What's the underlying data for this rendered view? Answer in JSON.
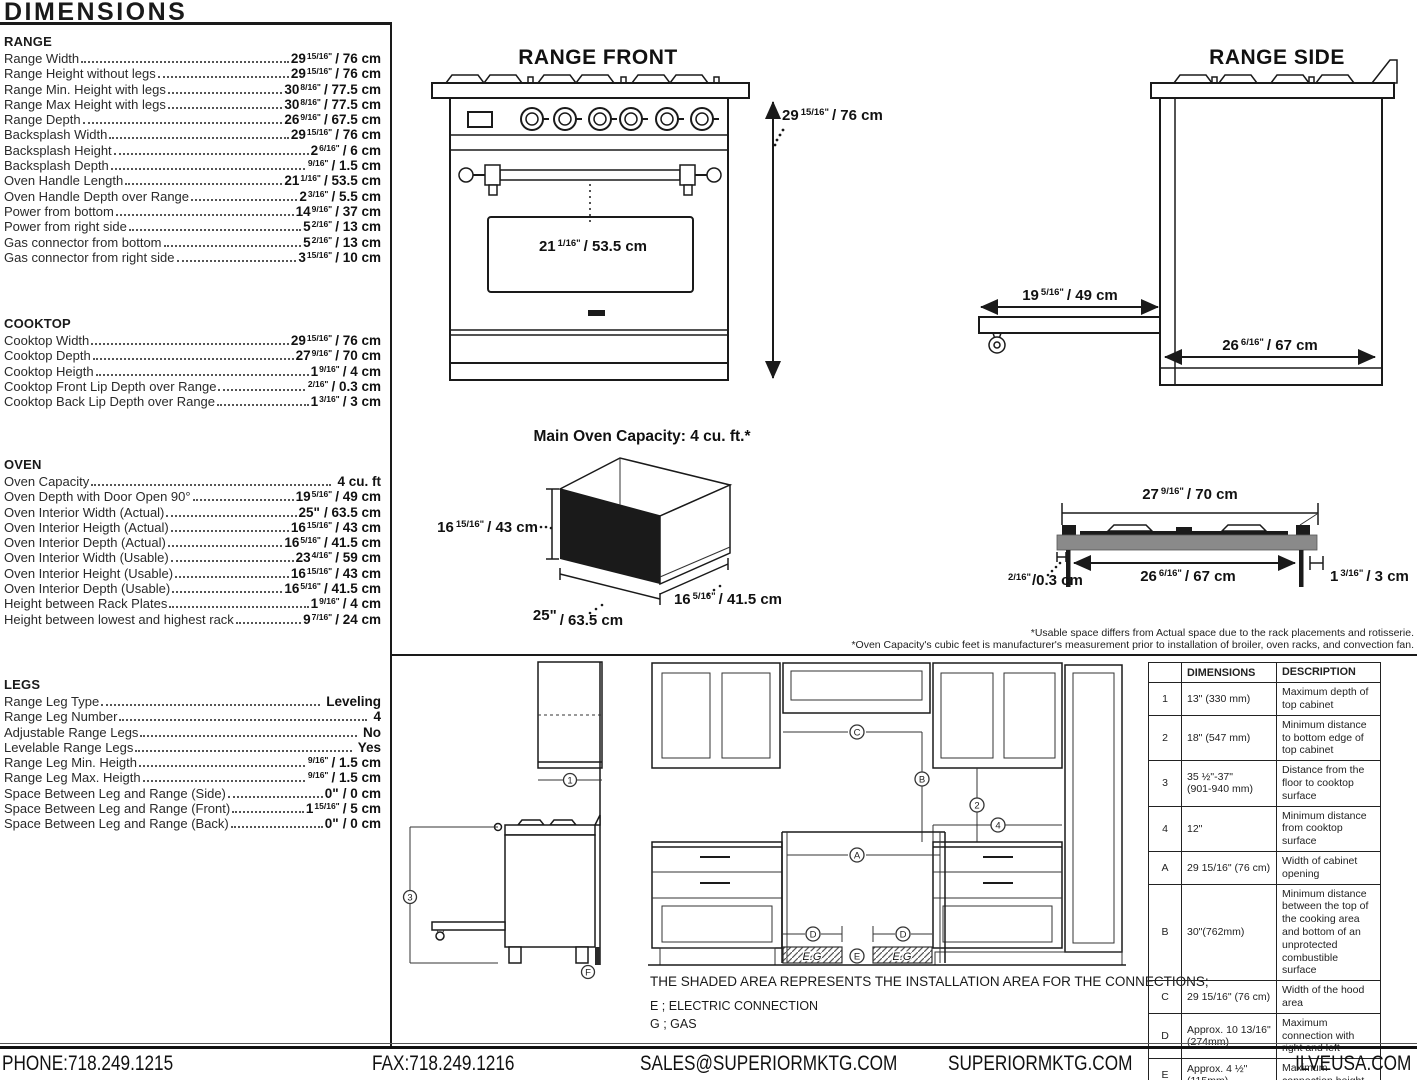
{
  "title": "DIMENSIONS",
  "specs": {
    "range": {
      "heading": "RANGE",
      "items": [
        {
          "label": "Range Width",
          "imp": "29",
          "frac": "15/16\"",
          "met": "/ 76 cm"
        },
        {
          "label": "Range Height without legs",
          "imp": "29",
          "frac": "15/16\"",
          "met": "/ 76 cm"
        },
        {
          "label": "Range Min. Height with legs",
          "imp": "30",
          "frac": "8/16\"",
          "met": "/ 77.5 cm"
        },
        {
          "label": "Range Max Height with legs",
          "imp": "30",
          "frac": "8/16\"",
          "met": "/ 77.5 cm"
        },
        {
          "label": "Range Depth",
          "imp": "26",
          "frac": "9/16\"",
          "met": "/ 67.5 cm"
        },
        {
          "label": "Backsplash Width",
          "imp": "29",
          "frac": "15/16\"",
          "met": "/ 76 cm"
        },
        {
          "label": "Backsplash Height",
          "imp": "2",
          "frac": "6/16\"",
          "met": "/ 6 cm"
        },
        {
          "label": "Backsplash Depth",
          "imp": "",
          "frac": "9/16\"",
          "met": "/ 1.5 cm"
        },
        {
          "label": "Oven Handle Length",
          "imp": "21",
          "frac": "1/16\"",
          "met": "/ 53.5 cm"
        },
        {
          "label": "Oven Handle Depth over Range",
          "imp": "2",
          "frac": "3/16\"",
          "met": "/ 5.5 cm"
        },
        {
          "label": "Power from bottom",
          "imp": "14",
          "frac": "9/16\"",
          "met": "/ 37 cm"
        },
        {
          "label": "Power from right side",
          "imp": "5",
          "frac": "2/16\"",
          "met": "/ 13 cm"
        },
        {
          "label": "Gas connector from bottom",
          "imp": "5",
          "frac": "2/16\"",
          "met": "/ 13 cm"
        },
        {
          "label": "Gas connector from right side",
          "imp": "3",
          "frac": "15/16\"",
          "met": "/ 10 cm"
        }
      ]
    },
    "cooktop": {
      "heading": "COOKTOP",
      "items": [
        {
          "label": "Cooktop Width",
          "imp": "29",
          "frac": "15/16\"",
          "met": "/ 76 cm"
        },
        {
          "label": "Cooktop Depth",
          "imp": "27",
          "frac": "9/16\"",
          "met": "/ 70 cm"
        },
        {
          "label": "Cooktop Heigth",
          "imp": "1",
          "frac": "9/16\"",
          "met": "/ 4 cm"
        },
        {
          "label": "Cooktop Front Lip Depth over Range",
          "imp": "",
          "frac": "2/16\"",
          "met": "/ 0.3 cm"
        },
        {
          "label": "Cooktop Back Lip Depth over Range",
          "imp": "1",
          "frac": "3/16\"",
          "met": "/ 3 cm"
        }
      ]
    },
    "oven": {
      "heading": "OVEN",
      "items": [
        {
          "label": "Oven Capacity",
          "imp": "",
          "frac": "",
          "met": "4 cu. ft"
        },
        {
          "label": "Oven Depth with Door Open 90°",
          "imp": "19",
          "frac": "5/16\"",
          "met": "/ 49 cm"
        },
        {
          "label": "Oven Interior Width (Actual)",
          "imp": "25\"",
          "frac": "",
          "met": "/ 63.5 cm"
        },
        {
          "label": "Oven Interior Heigth (Actual)",
          "imp": "16",
          "frac": "15/16\"",
          "met": "/ 43 cm"
        },
        {
          "label": "Oven Interior Depth (Actual)",
          "imp": "16",
          "frac": "5/16\"",
          "met": "/ 41.5 cm"
        },
        {
          "label": "Oven Interior Width (Usable)",
          "imp": "23",
          "frac": "4/16\"",
          "met": "/ 59 cm"
        },
        {
          "label": "Oven Interior Height (Usable)",
          "imp": "16",
          "frac": "15/16\"",
          "met": "/ 43 cm"
        },
        {
          "label": "Oven Interior Depth (Usable)",
          "imp": "16",
          "frac": "5/16\"",
          "met": "/ 41.5 cm"
        },
        {
          "label": "Height between Rack Plates",
          "imp": "1",
          "frac": "9/16\"",
          "met": "/ 4 cm"
        },
        {
          "label": "Height between lowest and highest rack",
          "imp": "9",
          "frac": "7/16\"",
          "met": "/ 24 cm"
        }
      ]
    },
    "legs": {
      "heading": "LEGS",
      "items": [
        {
          "label": "Range Leg Type",
          "imp": "",
          "frac": "",
          "met": "Leveling"
        },
        {
          "label": "Range Leg Number",
          "imp": "",
          "frac": "",
          "met": "4"
        },
        {
          "label": "Adjustable Range Legs",
          "imp": "",
          "frac": "",
          "met": "No"
        },
        {
          "label": "Levelable Range Legs",
          "imp": "",
          "frac": "",
          "met": "Yes"
        },
        {
          "label": "Range Leg Min. Heigth",
          "imp": "",
          "frac": "9/16\"",
          "met": "/ 1.5 cm"
        },
        {
          "label": "Range Leg Max. Heigth",
          "imp": "",
          "frac": "9/16\"",
          "met": "/ 1.5 cm"
        },
        {
          "label": "Space Between Leg and Range (Side)",
          "imp": "0\"",
          "frac": "",
          "met": "/ 0 cm"
        },
        {
          "label": "Space Between Leg and Range (Front)",
          "imp": "1",
          "frac": "15/16\"",
          "met": "/ 5 cm"
        },
        {
          "label": "Space Between Leg and Range (Back)",
          "imp": "0\"",
          "frac": "",
          "met": "/ 0 cm"
        }
      ]
    }
  },
  "diagrams": {
    "range_front": {
      "title": "RANGE FRONT",
      "height": {
        "imp": "29",
        "frac": "15/16\"",
        "met": "/ 76 cm"
      },
      "handle": {
        "imp": "21",
        "frac": "1/16\"",
        "met": "/ 53.5 cm"
      }
    },
    "range_side": {
      "title": "RANGE SIDE",
      "door_open": {
        "imp": "19",
        "frac": "5/16\"",
        "met": "/ 49 cm"
      },
      "depth": {
        "imp": "26",
        "frac": "6/16\"",
        "met": "/ 67 cm"
      }
    },
    "oven_capacity": {
      "title": "Main Oven Capacity: 4 cu. ft.*",
      "height": {
        "imp": "16",
        "frac": "15/16\"",
        "met": "/ 43 cm"
      },
      "width": {
        "imp": "25\"",
        "frac": "",
        "met": "/ 63.5 cm"
      },
      "depth": {
        "imp": "16",
        "frac": "5/16\"",
        "met": "/ 41.5 cm"
      }
    },
    "cooktop_profile": {
      "width": {
        "imp": "27",
        "frac": "9/16\"",
        "met": "/ 70 cm"
      },
      "inner_width": {
        "imp": "26",
        "frac": "6/16\"",
        "met": "/ 67 cm"
      },
      "back_lip": {
        "imp": "1",
        "frac": "3/16\"",
        "met": "/ 3 cm"
      },
      "front_lip": {
        "imp": "",
        "frac": "2/16\"",
        "met": "/0.3 cm"
      }
    }
  },
  "footnotes": {
    "line1": "*Usable space differs from Actual space due to the rack placements and rotisserie.",
    "line2": "*Oven Capacity's cubic feet is manufacturer's measurement prior to installation of broiler, oven racks, and convection fan."
  },
  "installation": {
    "note": "THE SHADED AREA REPRESENTS THE INSTALLATION AREA FOR THE CONNECTIONS;",
    "legend_electric": "E ; ELECTRIC CONNECTION",
    "legend_gas": "G ; GAS",
    "shaded_label": "E.G",
    "markers": {
      "m1": "1",
      "m2": "2",
      "m3": "3",
      "m4": "4",
      "mA": "A",
      "mB": "B",
      "mC": "C",
      "mD": "D",
      "mE": "E",
      "mF": "F"
    }
  },
  "table": {
    "headers": {
      "dimensions": "DIMENSIONS",
      "description": "DESCRIPTION"
    },
    "rows": [
      {
        "id": "1",
        "dim1": "13\" (330 mm)",
        "dim2": "",
        "desc": "Maximum depth of top cabinet"
      },
      {
        "id": "2",
        "dim1": "18\" (547 mm)",
        "dim2": "",
        "desc": "Minimum distance to bottom edge of top cabinet"
      },
      {
        "id": "3",
        "dim1": "35 ½\"-37\"",
        "dim2": "(901-940 mm)",
        "desc": "Distance from the floor to cooktop surface"
      },
      {
        "id": "4",
        "dim1": "12\"",
        "dim2": "",
        "desc": "Minimum distance from cooktop surface"
      },
      {
        "id": "A",
        "dim1": "29 15/16\" (76 cm)",
        "dim2": "",
        "desc": "Width of cabinet opening"
      },
      {
        "id": "B",
        "dim1": "30\"(762mm)",
        "dim2": "",
        "desc": "Minimum distance between the top of the cooking area and bottom of an unprotected combustible surface"
      },
      {
        "id": "C",
        "dim1": "29 15/16\" (76 cm)",
        "dim2": "",
        "desc": "Width of the hood area"
      },
      {
        "id": "D",
        "dim1": "Approx. 10 13/16\"",
        "dim2": "(274mm)",
        "desc": "Maximum connection with right and left"
      },
      {
        "id": "E",
        "dim1": "Approx. 4 ½\"",
        "dim2": "(115mm)",
        "desc": "Maximum connection height"
      },
      {
        "id": "F",
        "dim1": "Approx. 2 13/16\"",
        "dim2": "(72mm)",
        "desc": "Maximum connection depth"
      }
    ]
  },
  "footer": {
    "phone": "PHONE:718.249.1215",
    "fax": "FAX:718.249.1216",
    "email": "SALES@SUPERIORMKTG.COM",
    "site": "SUPERIORMKTG.COM",
    "site2": "ILVEUSA.COM"
  }
}
